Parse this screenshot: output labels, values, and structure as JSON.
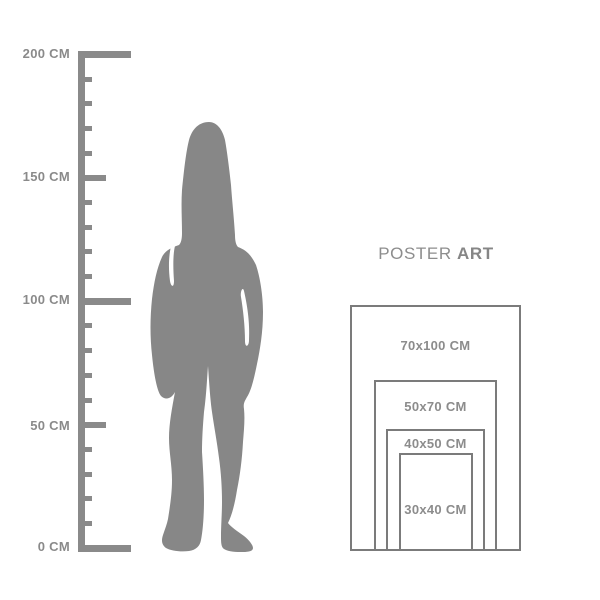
{
  "page": {
    "background": "#ffffff"
  },
  "ruler": {
    "unit": "CM",
    "min_cm": 0,
    "max_cm": 200,
    "tick_step_cm": 10,
    "color": "#8a8a8a",
    "labels": [
      {
        "value": 200,
        "text": "200 CM"
      },
      {
        "value": 150,
        "text": "150 CM"
      },
      {
        "value": 100,
        "text": "100 CM"
      },
      {
        "value": 50,
        "text": "50 CM"
      },
      {
        "value": 0,
        "text": "0 CM"
      }
    ]
  },
  "figure": {
    "description": "gray silhouette of a standing woman with long hair, approx 170 cm against the ruler",
    "color": "#878787"
  },
  "brand": {
    "word_regular": "POSTER",
    "word_bold": "ART"
  },
  "size_chart": {
    "unit": "CM",
    "border_color": "#7b7b7b",
    "label_color": "#8c8c8c",
    "sizes": [
      {
        "label": "70x100 CM",
        "width_cm": 70,
        "height_cm": 100
      },
      {
        "label": "50x70 CM",
        "width_cm": 50,
        "height_cm": 70
      },
      {
        "label": "40x50 CM",
        "width_cm": 40,
        "height_cm": 50
      },
      {
        "label": "30x40 CM",
        "width_cm": 30,
        "height_cm": 40
      }
    ]
  }
}
